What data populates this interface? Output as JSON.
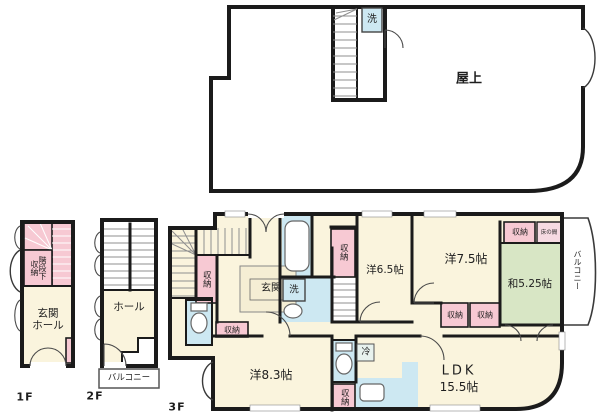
{
  "floor_plan": {
    "roof": {
      "label": "屋上",
      "washer": "洗"
    },
    "floor1": {
      "label": "1F",
      "stair_storage": "階段下収納",
      "entrance_hall": "玄関\nホール"
    },
    "floor2": {
      "label": "2F",
      "hall": "ホール",
      "balcony": "バルコニー"
    },
    "floor3": {
      "label": "3F",
      "entrance": "玄関",
      "washer": "洗",
      "closet": "収納",
      "fridge": "冷",
      "tokonoma": "床の間",
      "balcony": "バルコニー",
      "room_w65": "洋6.5帖",
      "room_w75": "洋7.5帖",
      "room_j525": "和5.25帖",
      "room_w83": "洋8.3帖",
      "ldk": "LDK",
      "ldk_size": "15.5帖"
    },
    "colors": {
      "wall": "#1b1b1b",
      "room": "#faf4dd",
      "pink": "#f7c9d3",
      "wet": "#cde8f2",
      "tatami": "#d8e6c5"
    }
  }
}
